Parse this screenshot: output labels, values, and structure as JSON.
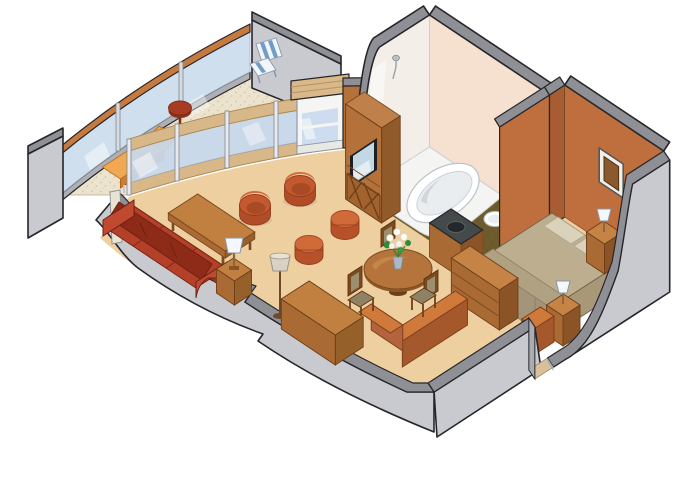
{
  "scene": {
    "type": "isometric-cutaway-floor-plan",
    "subject_label": "Cruise ship suite floor plan illustration",
    "background": "#ffffff",
    "rooms": [
      {
        "id": "balcony",
        "label": "Balcony",
        "floor_color": "#ece3cf",
        "items": [
          "glass-balustrade",
          "rail-cap",
          "chaise-lounge",
          "round-side-table",
          "striped-deck-chair",
          "privacy-partition"
        ]
      },
      {
        "id": "living-room",
        "label": "Living room",
        "floor_color": "#edcfa0",
        "items": [
          "red-sofa",
          "coffee-table",
          "side-table-with-lamp",
          "barrel-chair",
          "barrel-chair",
          "ottoman",
          "ottoman",
          "desk",
          "floor-lamp",
          "balcony-door",
          "tv-cabinet"
        ]
      },
      {
        "id": "dining-area",
        "label": "Dining area",
        "floor_color": "#edcfa0",
        "items": [
          "round-dining-table",
          "dining-chair",
          "dining-chair",
          "dining-chair",
          "flower-bouquet"
        ]
      },
      {
        "id": "bathroom",
        "label": "Bathroom",
        "floor_color": "#6e5c2c",
        "wall_color": "#f6e0d0",
        "items": [
          "bathtub",
          "toilet",
          "vanity-sink",
          "shower-head"
        ]
      },
      {
        "id": "bedroom",
        "label": "Bedroom",
        "floor_color": "#edcfa0",
        "items": [
          "double-bed",
          "pillows",
          "blanket",
          "nightstand-with-lamp",
          "nightstand-with-lamp",
          "dresser",
          "framed-picture"
        ]
      },
      {
        "id": "entry-corridor",
        "label": "Entry corridor",
        "floor_color": "#edcfa0",
        "items": [
          "low-partition-wall",
          "low-partition-wall",
          "entry-door-opening"
        ]
      }
    ],
    "palette": {
      "outline": "#26262a",
      "wall_gray": "#c9cacf",
      "wall_gray_top": "#8f9095",
      "interior_wall_orange": "#bf6f3e",
      "interior_wall_dark": "#a85c32",
      "floor_tan": "#edcfa0",
      "deck_speckle": "#ece3cf",
      "glass_blue": "#c8d9ec",
      "wood_rail_tan": "#d8b888",
      "rail_cap_orange": "#c67a3e",
      "furniture_terracotta": "#c4582e",
      "sofa_red": "#b5402a",
      "wood_mid": "#b5713a",
      "wood_light": "#c1803f",
      "wood_dark": "#8a5427",
      "bath_wall_peach": "#f6e0d0",
      "bath_wall_white": "#f3efe8",
      "tile_olive": "#6e5c2c",
      "bed_khaki": "#bdae8f",
      "lamp_white": "#f4f7fb"
    }
  }
}
